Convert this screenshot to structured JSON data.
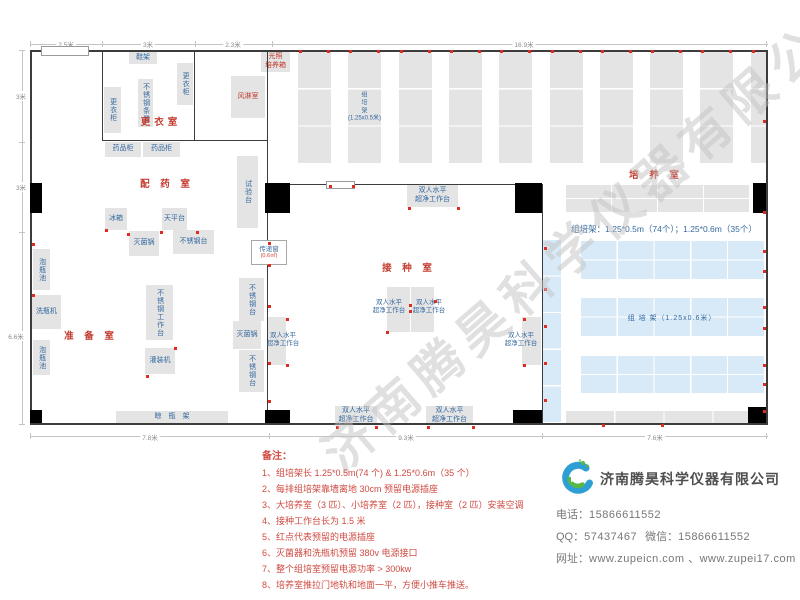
{
  "watermark": {
    "text": "济南腾昊科学仪器有限公司"
  },
  "colors": {
    "room_label": "#c43c30",
    "equip_label": "#34699f",
    "wall": "#3c3c3c",
    "rack_gray": "#e4e4e4",
    "rack_blue": "#d8eaf8",
    "socket": "#e02b20",
    "notes_red": "#cf4a42",
    "watermark_gray": "#c1c1c1"
  },
  "plan": {
    "walls": [
      [
        30,
        50,
        738,
        2
      ],
      [
        30,
        50,
        2,
        375
      ],
      [
        30,
        423,
        738,
        2
      ],
      [
        766,
        50,
        2,
        375
      ],
      [
        102,
        50,
        1,
        91
      ],
      [
        194,
        50,
        1,
        91
      ],
      [
        102,
        140,
        166,
        1
      ],
      [
        267,
        50,
        1,
        375
      ],
      [
        268,
        184,
        275,
        1
      ],
      [
        542,
        184,
        1,
        241
      ]
    ],
    "doors": [
      [
        41,
        46,
        46,
        8
      ],
      [
        326,
        181,
        27,
        6
      ]
    ],
    "columns": [
      [
        30,
        183,
        12,
        30
      ],
      [
        265,
        183,
        25,
        30
      ],
      [
        515,
        183,
        27,
        30
      ],
      [
        753,
        183,
        13,
        30
      ],
      [
        30,
        410,
        12,
        13
      ],
      [
        265,
        410,
        25,
        13
      ],
      [
        513,
        410,
        29,
        13
      ],
      [
        748,
        407,
        18,
        16
      ]
    ],
    "equipment": [
      {
        "n": "shoe-rack",
        "l": "鞋架",
        "b": [
          129,
          52,
          28,
          12
        ]
      },
      {
        "n": "locker-right",
        "l": "更衣柜",
        "b": [
          177,
          63,
          16,
          42
        ],
        "v": 1
      },
      {
        "n": "stainless-bench",
        "l": "不锈钢条凳",
        "b": [
          138,
          79,
          15,
          48
        ],
        "v": 1
      },
      {
        "n": "locker-left",
        "l": "更衣柜",
        "b": [
          104,
          87,
          17,
          46
        ],
        "v": 1
      },
      {
        "n": "air-shower-room",
        "l": "风淋室",
        "b": [
          231,
          76,
          34,
          42
        ],
        "red": 1
      },
      {
        "n": "medicine-cabinet-1",
        "l": "药品柜",
        "b": [
          105,
          142,
          36,
          15
        ]
      },
      {
        "n": "medicine-cabinet-2",
        "l": "药品柜",
        "b": [
          143,
          142,
          37,
          15
        ]
      },
      {
        "n": "test-bench",
        "l": "试验台",
        "b": [
          237,
          156,
          21,
          72
        ],
        "v": 1
      },
      {
        "n": "fridge",
        "l": "冰箱",
        "b": [
          105,
          208,
          22,
          22
        ]
      },
      {
        "n": "balance-table",
        "l": "天平台",
        "b": [
          162,
          208,
          25,
          22
        ]
      },
      {
        "n": "soak-pool-1",
        "l": "泡瓶池",
        "b": [
          33,
          249,
          17,
          41
        ],
        "v": 1
      },
      {
        "n": "bottle-washer",
        "l": "洗瓶机",
        "b": [
          32,
          295,
          29,
          34
        ]
      },
      {
        "n": "soak-pool-2",
        "l": "泡瓶池",
        "b": [
          33,
          340,
          17,
          35
        ],
        "v": 1
      },
      {
        "n": "sterilizer-1",
        "l": "灭菌锅",
        "b": [
          129,
          231,
          30,
          25
        ]
      },
      {
        "n": "steel-table-1",
        "l": "不锈钢台",
        "b": [
          173,
          230,
          41,
          24
        ]
      },
      {
        "n": "steel-worktable",
        "l": "不锈钢工作台",
        "b": [
          146,
          285,
          27,
          55
        ],
        "v": 1
      },
      {
        "n": "filling-machine",
        "l": "灌装机",
        "b": [
          145,
          348,
          30,
          26
        ]
      },
      {
        "n": "steel-table-2",
        "l": "不锈钢台",
        "b": [
          239,
          278,
          25,
          43
        ],
        "v": 1
      },
      {
        "n": "sterilizer-2",
        "l": "灭菌锅",
        "b": [
          233,
          321,
          28,
          28
        ]
      },
      {
        "n": "steel-table-3",
        "l": "不锈钢台",
        "b": [
          239,
          350,
          25,
          42
        ],
        "v": 1
      },
      {
        "n": "bottle-drying-rack",
        "l": "晾　瓶　架",
        "b": [
          116,
          411,
          112,
          13
        ]
      },
      {
        "n": "light-incubator",
        "l": "光照\n培养箱",
        "b": [
          261,
          51,
          29,
          21
        ],
        "red": 1
      },
      {
        "n": "clean-bench-top",
        "l": "双人水平\n超净工作台",
        "b": [
          407,
          184,
          51,
          23
        ]
      },
      {
        "n": "clean-bench-left",
        "l": "",
        "b": [
          267,
          317,
          19,
          48
        ]
      },
      {
        "n": "clean-bench-center-1",
        "l": "",
        "b": [
          387,
          287,
          23,
          45
        ]
      },
      {
        "n": "clean-bench-center-2",
        "l": "",
        "b": [
          411,
          287,
          23,
          45
        ]
      },
      {
        "n": "clean-bench-right",
        "l": "",
        "b": [
          522,
          317,
          19,
          48
        ]
      },
      {
        "n": "clean-bench-bottom-1",
        "l": "双人水平\n超净工作台",
        "b": [
          335,
          406,
          42,
          19
        ]
      },
      {
        "n": "clean-bench-bottom-2",
        "l": "双人水平\n超净工作台",
        "b": [
          426,
          406,
          47,
          19
        ]
      }
    ],
    "pass_window": {
      "n": "pass-window",
      "l1": "传递窗",
      "l2": "(0.6㎡)",
      "b": [
        251,
        240,
        34,
        23
      ]
    },
    "room_labels": [
      {
        "n": "room-label-changing",
        "t": "更衣室",
        "c": [
          161,
          121
        ]
      },
      {
        "n": "room-label-medicine",
        "t": "配 药 室",
        "c": [
          167,
          183
        ]
      },
      {
        "n": "room-label-prep",
        "t": "准 备 室",
        "c": [
          91,
          335
        ]
      },
      {
        "n": "room-label-inoculation",
        "t": "接 种 室",
        "c": [
          409,
          267
        ]
      },
      {
        "n": "room-label-culture",
        "t": "培 养 室",
        "c": [
          656,
          174
        ]
      }
    ],
    "bench_labels": [
      {
        "n": "clean-bench-left-label",
        "t": "双人水平\n超净工作台",
        "c": [
          283,
          340
        ]
      },
      {
        "n": "clean-bench-center-1-label",
        "t": "双人水平\n超净工作台",
        "c": [
          389,
          307
        ]
      },
      {
        "n": "clean-bench-center-2-label",
        "t": "双人水平\n超净工作台",
        "c": [
          429,
          307
        ]
      },
      {
        "n": "clean-bench-right-label",
        "t": "双人水平\n超净工作台",
        "c": [
          521,
          340
        ]
      }
    ],
    "texts": [
      {
        "n": "rack-spec-note",
        "t": "组培架：1.25*0.5m（74个）；1.25*0.6m（35个）",
        "c": [
          664,
          229
        ],
        "cls": "spec"
      },
      {
        "n": "rack-blue-label",
        "t": "组 培 架（1.25x0.6米）",
        "c": [
          672,
          318
        ],
        "cls": "bluelabel"
      }
    ],
    "racks": {
      "top_strips": {
        "x0": 298,
        "pitch": 50.3,
        "count": 10,
        "y": 52,
        "w": 33,
        "h": 112,
        "rows": 3,
        "clip": 766,
        "label_index": 1,
        "label": "组\n培\n架\n(1.25x0.5米)"
      },
      "flat": [
        {
          "n": "rack-gray-upper",
          "b": [
            566,
            185,
            184,
            28
          ],
          "cls": "gray",
          "rows": 2,
          "cols": 4
        },
        {
          "n": "rack-blue-vstrip",
          "b": [
            543,
            240,
            18,
            183
          ],
          "cls": "blue",
          "rows": 5,
          "cols": 1
        },
        {
          "n": "rack-blue-band-1",
          "b": [
            581,
            241,
            184,
            39
          ],
          "cls": "blue",
          "rows": 2,
          "cols": 5
        },
        {
          "n": "rack-blue-band-2",
          "b": [
            581,
            298,
            184,
            39
          ],
          "cls": "blue",
          "rows": 2,
          "cols": 5
        },
        {
          "n": "rack-blue-band-3",
          "b": [
            581,
            356,
            184,
            38
          ],
          "cls": "blue",
          "rows": 2,
          "cols": 5
        },
        {
          "n": "rack-gray-bottom",
          "b": [
            566,
            411,
            197,
            12
          ],
          "cls": "gray",
          "rows": 1,
          "cols": 4
        }
      ]
    },
    "sockets": [
      [
        32,
        243
      ],
      [
        32,
        294
      ],
      [
        268,
        242
      ],
      [
        268,
        264
      ],
      [
        268,
        305
      ],
      [
        268,
        362
      ],
      [
        268,
        400
      ],
      [
        105,
        229
      ],
      [
        127,
        233
      ],
      [
        160,
        231
      ],
      [
        196,
        231
      ],
      [
        146,
        375
      ],
      [
        174,
        347
      ],
      [
        336,
        426
      ],
      [
        375,
        426
      ],
      [
        427,
        426
      ],
      [
        472,
        426
      ],
      [
        602,
        424
      ],
      [
        661,
        424
      ],
      [
        409,
        304
      ],
      [
        409,
        310
      ],
      [
        386,
        331
      ],
      [
        434,
        300
      ],
      [
        286,
        318
      ],
      [
        286,
        364
      ],
      [
        523,
        318
      ],
      [
        523,
        364
      ],
      [
        763,
        120
      ],
      [
        763,
        211
      ],
      [
        763,
        250
      ],
      [
        763,
        270
      ],
      [
        763,
        306
      ],
      [
        763,
        327
      ],
      [
        763,
        364
      ],
      [
        763,
        383
      ],
      [
        763,
        410
      ],
      [
        544,
        247
      ],
      [
        544,
        288
      ],
      [
        544,
        325
      ],
      [
        544,
        362
      ],
      [
        544,
        399
      ],
      [
        329,
        185
      ],
      [
        352,
        185
      ],
      [
        408,
        207
      ],
      [
        457,
        207
      ]
    ],
    "dim_lines": [
      [
        30,
        44,
        738,
        1
      ],
      [
        30,
        41,
        1,
        6
      ],
      [
        102,
        41,
        1,
        6
      ],
      [
        195,
        41,
        1,
        6
      ],
      [
        272,
        41,
        1,
        6
      ],
      [
        766,
        41,
        1,
        6
      ],
      [
        22,
        50,
        1,
        375
      ],
      [
        19,
        50,
        6,
        1
      ],
      [
        19,
        142,
        6,
        1
      ],
      [
        19,
        232,
        6,
        1
      ],
      [
        19,
        424,
        6,
        1
      ],
      [
        30,
        436,
        738,
        1
      ],
      [
        30,
        433,
        1,
        6
      ],
      [
        269,
        433,
        1,
        6
      ],
      [
        542,
        433,
        1,
        6
      ],
      [
        766,
        433,
        1,
        6
      ]
    ],
    "dim_labels": [
      {
        "t": "2.5米",
        "c": [
          66,
          44
        ]
      },
      {
        "t": "3米",
        "c": [
          148,
          44
        ]
      },
      {
        "t": "2.3米",
        "c": [
          233,
          44
        ]
      },
      {
        "t": "16.9米",
        "c": [
          524,
          44
        ]
      },
      {
        "t": "3米",
        "c": [
          21,
          96
        ]
      },
      {
        "t": "3米",
        "c": [
          21,
          187
        ]
      },
      {
        "t": "6.6米",
        "c": [
          16,
          336
        ]
      },
      {
        "t": "7.8米",
        "c": [
          150,
          437
        ]
      },
      {
        "t": "9.3米",
        "c": [
          406,
          437
        ]
      },
      {
        "t": "7.6米",
        "c": [
          655,
          437
        ]
      }
    ]
  },
  "notes": {
    "title": "备注：",
    "items": [
      "1、组培架长 1.25*0.5m(74 个) & 1.25*0.6m（35 个）",
      "2、每排组培架靠墙离地 30cm 预留电源插座",
      "3、大培养室（3 匹）、小培养室（2 匹），接种室（2 匹）安装空调",
      "4、接种工作台长为 1.5 米",
      "5、红点代表预留的电源插座",
      "6、灭菌器和洗瓶机预留 380v 电源接口",
      "7、整个组培室预留电源功率 > 300kw",
      "8、培养室推拉门地轨和地面一平，方便小推车推送。"
    ]
  },
  "company": {
    "name": "济南腾昊科学仪器有限公司",
    "logo_text": "TH",
    "contacts": [
      [
        {
          "label": "电话：",
          "value": "15866611552"
        }
      ],
      [
        {
          "label": "QQ：",
          "value": "57437467"
        },
        {
          "label": "微信：",
          "value": "15866611552"
        }
      ],
      [
        {
          "label": "网址：",
          "value": "www.zupeicn.com 、www.zupei17.com"
        }
      ]
    ]
  }
}
